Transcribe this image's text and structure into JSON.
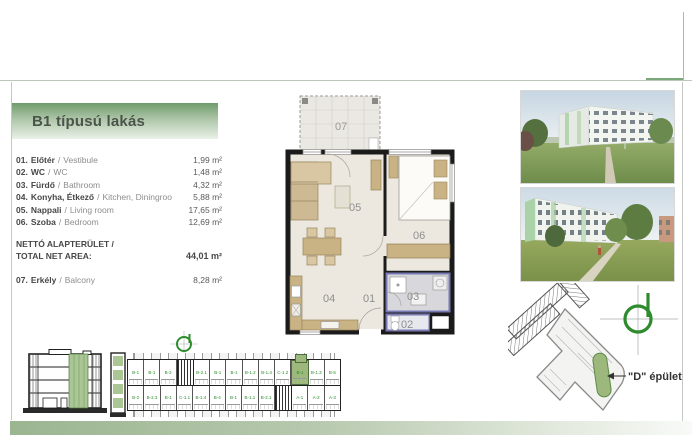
{
  "header": {
    "title": "B1 típusú lakás"
  },
  "room_list": {
    "sep": "/",
    "items": [
      {
        "num": "01.",
        "hu": "Előtér",
        "en": "Vestibule",
        "area": "1,99 m²"
      },
      {
        "num": "02.",
        "hu": "WC",
        "en": "WC",
        "area": "1,48 m²"
      },
      {
        "num": "03.",
        "hu": "Fürdő",
        "en": "Bathroom",
        "area": "4,32 m²"
      },
      {
        "num": "04.",
        "hu": "Konyha, Étkező",
        "en": "Kitchen, Diningroom",
        "area": "5,88 m²"
      },
      {
        "num": "05.",
        "hu": "Nappali",
        "en": "Living room",
        "area": "17,65 m²"
      },
      {
        "num": "06.",
        "hu": "Szoba",
        "en": "Bedroom",
        "area": "12,69 m²"
      }
    ],
    "total": {
      "label_hu": "NETTÓ ALAPTERÜLET /",
      "label_en": "TOTAL NET AREA:",
      "area": "44,01 m²"
    },
    "balcony": {
      "num": "07.",
      "hu": "Erkély",
      "en": "Balcony",
      "area": "8,28 m²"
    }
  },
  "floor_plan": {
    "labels": {
      "hall": "01",
      "wc": "02",
      "bath": "03",
      "kitchen": "04",
      "living": "05",
      "bedroom": "06",
      "balcony": "07"
    }
  },
  "site_plan": {
    "building_label": "\"D\" épület"
  },
  "floor_strip": {
    "highlighted_index": 10,
    "top_units": [
      "B-1",
      "B-1",
      "B-2",
      "",
      "B-2.1",
      "B-1",
      "B-1",
      "B-1.2",
      "B-1.4",
      "C-1.2",
      "B-1",
      "B-1.3",
      "B-5"
    ],
    "bottom_units": [
      "B-2",
      "B-2.3",
      "B-1",
      "C-1.1",
      "B-1.4",
      "B-4",
      "B-1",
      "B-1.1",
      "B-2.1",
      "",
      "A-1",
      "A-2",
      "A-3"
    ]
  },
  "icons": {
    "north_logo": "compass-d-logo-icon"
  },
  "colors": {
    "accent_green": "#6f9c6c",
    "room_highlight_blue": "#7777b2",
    "plan_highlight_green": "#9cb87c",
    "logo_green": "#2e8b2e",
    "section_green": "#a9c694",
    "bottom_bar_green": "#9bb591"
  }
}
